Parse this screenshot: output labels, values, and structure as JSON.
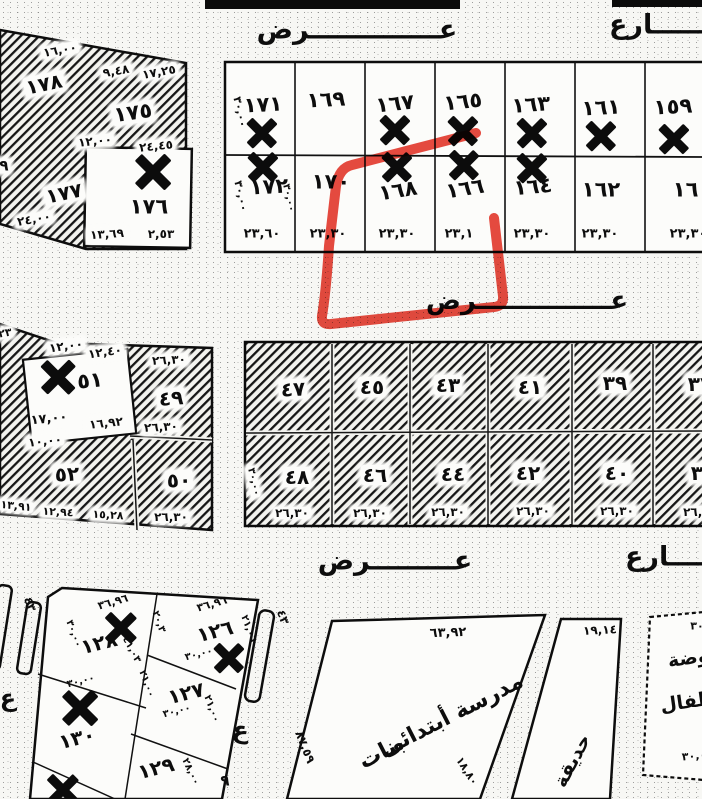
{
  "map": {
    "type": "scanned cadastral plot map",
    "annotation_color": "#e4372b",
    "ink_color": "#0d0d0d",
    "paper_color": "#f7f7f4"
  },
  "labels": {
    "streets": [
      {
        "n": "street-top-ard-label",
        "t": "عــــــــــــــرض",
        "x": 357,
        "y": 30,
        "s": 27,
        "r": 0
      },
      {
        "n": "street-top-sharia-label",
        "t": "شــــــارع",
        "x": 672,
        "y": 25,
        "s": 27,
        "r": 0
      },
      {
        "n": "street-middle-ard-label",
        "t": "عـــــــــــــــرض",
        "x": 527,
        "y": 301,
        "s": 26,
        "r": 0
      },
      {
        "n": "street-bottom-ard-label",
        "t": "عـــــــــرض",
        "x": 395,
        "y": 561,
        "s": 27,
        "r": 0
      },
      {
        "n": "street-bottom-sharia-label",
        "t": "شــــــارع",
        "x": 688,
        "y": 557,
        "s": 27,
        "r": 0
      }
    ],
    "top_block_numbers": [
      {
        "n": "parcel-171",
        "t": "١٧١",
        "x": 263,
        "y": 105,
        "s": 21,
        "r": -3
      },
      {
        "n": "parcel-169",
        "t": "١٦٩",
        "x": 326,
        "y": 100,
        "s": 21,
        "r": -3
      },
      {
        "n": "parcel-167",
        "t": "١٦٧",
        "x": 395,
        "y": 104,
        "s": 21,
        "r": -6
      },
      {
        "n": "parcel-165",
        "t": "١٦٥",
        "x": 463,
        "y": 102,
        "s": 21,
        "r": -6
      },
      {
        "n": "parcel-163",
        "t": "١٦٣",
        "x": 531,
        "y": 105,
        "s": 21,
        "r": -4
      },
      {
        "n": "parcel-161",
        "t": "١٦١",
        "x": 601,
        "y": 108,
        "s": 21,
        "r": -3
      },
      {
        "n": "parcel-159",
        "t": "١٥٩",
        "x": 673,
        "y": 107,
        "s": 21,
        "r": -3
      },
      {
        "n": "parcel-172",
        "t": "١٧٢",
        "x": 269,
        "y": 187,
        "s": 21,
        "r": -3
      },
      {
        "n": "parcel-170",
        "t": "١٧٠",
        "x": 331,
        "y": 182,
        "s": 21,
        "r": 0
      },
      {
        "n": "parcel-168",
        "t": "١٦٨",
        "x": 398,
        "y": 191,
        "s": 21,
        "r": -9
      },
      {
        "n": "parcel-166",
        "t": "١٦٦",
        "x": 465,
        "y": 189,
        "s": 21,
        "r": -9
      },
      {
        "n": "parcel-164",
        "t": "١٦٤",
        "x": 533,
        "y": 187,
        "s": 21,
        "r": -5
      },
      {
        "n": "parcel-162",
        "t": "١٦٢",
        "x": 601,
        "y": 190,
        "s": 21,
        "r": 0
      },
      {
        "n": "parcel-160",
        "t": "١٦٠",
        "x": 692,
        "y": 190,
        "s": 21,
        "r": 0
      }
    ],
    "top_block_dims": [
      {
        "n": "dim",
        "t": "٢٣,٦٠",
        "x": 262,
        "y": 234,
        "s": 13,
        "r": 0
      },
      {
        "n": "dim",
        "t": "٢٣,٣٠",
        "x": 328,
        "y": 234,
        "s": 13,
        "r": 0
      },
      {
        "n": "dim",
        "t": "٢٣,٣٠",
        "x": 397,
        "y": 234,
        "s": 13,
        "r": 0
      },
      {
        "n": "dim",
        "t": "٢٣,١",
        "x": 459,
        "y": 234,
        "s": 13,
        "r": 0
      },
      {
        "n": "dim",
        "t": "٢٣,٣٠",
        "x": 532,
        "y": 234,
        "s": 13,
        "r": 0
      },
      {
        "n": "dim",
        "t": "٢٣,٣٠",
        "x": 600,
        "y": 234,
        "s": 13,
        "r": 0
      },
      {
        "n": "dim",
        "t": "٢٣,٣٠",
        "x": 688,
        "y": 234,
        "s": 13,
        "r": 0
      },
      {
        "n": "dim-rot",
        "t": "٣٠,٠٠",
        "x": 240,
        "y": 112,
        "s": 11,
        "r": 78
      },
      {
        "n": "dim-rot",
        "t": "٣٠,٠٠",
        "x": 241,
        "y": 196,
        "s": 11,
        "r": 78
      },
      {
        "n": "dim-rot",
        "t": "٣٠,٠٠",
        "x": 288,
        "y": 198,
        "s": 10,
        "r": 78
      }
    ],
    "nw_block": [
      {
        "n": "parcel-178",
        "t": "١٧٨",
        "x": 44,
        "y": 84,
        "s": 20,
        "r": -12,
        "b": 1
      },
      {
        "n": "parcel-175",
        "t": "١٧٥",
        "x": 133,
        "y": 113,
        "s": 21,
        "r": -8,
        "b": 1
      },
      {
        "n": "parcel-177",
        "t": "١٧٧",
        "x": 64,
        "y": 193,
        "s": 20,
        "r": -12,
        "b": 1
      },
      {
        "n": "parcel-176",
        "t": "١٧٦",
        "x": 149,
        "y": 207,
        "s": 21,
        "r": 0
      },
      {
        "n": "dim",
        "t": "١٦,٠٠",
        "x": 60,
        "y": 50,
        "s": 12,
        "r": -10,
        "b": 1
      },
      {
        "n": "dim",
        "t": "٩,٤٨",
        "x": 116,
        "y": 71,
        "s": 12,
        "r": -10,
        "b": 1
      },
      {
        "n": "dim",
        "t": "١٧,٢٥",
        "x": 159,
        "y": 72,
        "s": 12,
        "r": -10,
        "b": 1
      },
      {
        "n": "dim",
        "t": "١٢,٠٠",
        "x": 95,
        "y": 141,
        "s": 12,
        "r": -6,
        "b": 1
      },
      {
        "n": "dim",
        "t": "٢٤,٤٥",
        "x": 156,
        "y": 146,
        "s": 12,
        "r": -6,
        "b": 1
      },
      {
        "n": "dim",
        "t": "٢٤,٠٠",
        "x": 34,
        "y": 219,
        "s": 12,
        "r": -10,
        "b": 1
      },
      {
        "n": "dim",
        "t": "١٣,٦٩",
        "x": 107,
        "y": 234,
        "s": 12,
        "r": -4,
        "b": 1
      },
      {
        "n": "dim",
        "t": "٢,٥٣",
        "x": 161,
        "y": 234,
        "s": 12,
        "r": 0
      },
      {
        "n": "fragment",
        "t": "٩",
        "x": 4,
        "y": 166,
        "s": 15,
        "r": 0,
        "b": 1
      }
    ],
    "left_block": [
      {
        "n": "parcel-51",
        "t": "٥١",
        "x": 90,
        "y": 381,
        "s": 21,
        "r": -6
      },
      {
        "n": "parcel-49",
        "t": "٤٩",
        "x": 171,
        "y": 398,
        "s": 20,
        "r": -4,
        "b": 1
      },
      {
        "n": "parcel-52",
        "t": "٥٢",
        "x": 67,
        "y": 474,
        "s": 20,
        "r": -3,
        "b": 1
      },
      {
        "n": "parcel-50",
        "t": "٥٠",
        "x": 179,
        "y": 480,
        "s": 20,
        "r": -3,
        "b": 1
      },
      {
        "n": "fragment",
        "t": "٢٣",
        "x": 5,
        "y": 333,
        "s": 11,
        "r": -10,
        "b": 1
      },
      {
        "n": "dim",
        "t": "١٢,٠٠",
        "x": 66,
        "y": 346,
        "s": 12,
        "r": -8,
        "b": 1
      },
      {
        "n": "dim",
        "t": "١٢,٤٠",
        "x": 105,
        "y": 352,
        "s": 12,
        "r": -8,
        "b": 1
      },
      {
        "n": "dim",
        "t": "٢٦,٣٠",
        "x": 169,
        "y": 360,
        "s": 12,
        "r": -3,
        "b": 1
      },
      {
        "n": "dim",
        "t": "١٧,٠٠",
        "x": 49,
        "y": 419,
        "s": 13,
        "r": -6
      },
      {
        "n": "dim",
        "t": "١٦,٩٢",
        "x": 106,
        "y": 423,
        "s": 12,
        "r": -6,
        "b": 1
      },
      {
        "n": "dim",
        "t": "٢٦,٣٠",
        "x": 161,
        "y": 427,
        "s": 12,
        "r": -3,
        "b": 1
      },
      {
        "n": "dim",
        "t": "١٠,٠٠",
        "x": 45,
        "y": 441,
        "s": 12,
        "r": -6,
        "b": 1
      },
      {
        "n": "dim",
        "t": "١٣,٩١",
        "x": 16,
        "y": 506,
        "s": 11,
        "r": 6,
        "b": 1
      },
      {
        "n": "dim",
        "t": "١٢,٩٤",
        "x": 58,
        "y": 512,
        "s": 11,
        "r": 3,
        "b": 1
      },
      {
        "n": "dim",
        "t": "١٥,٢٨",
        "x": 108,
        "y": 515,
        "s": 11,
        "r": 3,
        "b": 1
      },
      {
        "n": "dim",
        "t": "٢٦,٣٠",
        "x": 171,
        "y": 517,
        "s": 12,
        "r": 0,
        "b": 1
      }
    ],
    "main_block": [
      {
        "n": "parcel-47",
        "t": "٤٧",
        "x": 293,
        "y": 389,
        "s": 20,
        "r": -3,
        "b": 1
      },
      {
        "n": "parcel-45",
        "t": "٤٥",
        "x": 372,
        "y": 387,
        "s": 20,
        "r": 0,
        "b": 1
      },
      {
        "n": "parcel-43",
        "t": "٤٣",
        "x": 448,
        "y": 385,
        "s": 20,
        "r": 0,
        "b": 1
      },
      {
        "n": "parcel-41",
        "t": "٤١",
        "x": 530,
        "y": 387,
        "s": 20,
        "r": 0,
        "b": 1
      },
      {
        "n": "parcel-39",
        "t": "٣٩",
        "x": 615,
        "y": 383,
        "s": 20,
        "r": 0,
        "b": 1
      },
      {
        "n": "parcel-37",
        "t": "٣٧",
        "x": 700,
        "y": 384,
        "s": 20,
        "r": 0,
        "b": 1
      },
      {
        "n": "parcel-48",
        "t": "٤٨",
        "x": 297,
        "y": 477,
        "s": 20,
        "r": 0,
        "b": 1
      },
      {
        "n": "parcel-46",
        "t": "٤٦",
        "x": 375,
        "y": 475,
        "s": 20,
        "r": 0,
        "b": 1
      },
      {
        "n": "parcel-44",
        "t": "٤٤",
        "x": 453,
        "y": 474,
        "s": 20,
        "r": 0,
        "b": 1
      },
      {
        "n": "parcel-42",
        "t": "٤٢",
        "x": 528,
        "y": 473,
        "s": 20,
        "r": 0,
        "b": 1
      },
      {
        "n": "parcel-40",
        "t": "٤٠",
        "x": 617,
        "y": 473,
        "s": 20,
        "r": 0,
        "b": 1
      },
      {
        "n": "parcel-38",
        "t": "٣٨",
        "x": 703,
        "y": 473,
        "s": 20,
        "r": 0,
        "b": 1
      },
      {
        "n": "dim",
        "t": "٢٦,٣٠",
        "x": 292,
        "y": 513,
        "s": 12,
        "r": 0,
        "b": 1
      },
      {
        "n": "dim",
        "t": "٢٦,٣٠",
        "x": 370,
        "y": 513,
        "s": 12,
        "r": 0,
        "b": 1
      },
      {
        "n": "dim",
        "t": "٢٦,٣٠",
        "x": 448,
        "y": 512,
        "s": 12,
        "r": 0,
        "b": 1
      },
      {
        "n": "dim",
        "t": "٢٦,٣٠",
        "x": 533,
        "y": 511,
        "s": 12,
        "r": 0,
        "b": 1
      },
      {
        "n": "dim",
        "t": "٢٦,٣٠",
        "x": 617,
        "y": 511,
        "s": 12,
        "r": 0,
        "b": 1
      },
      {
        "n": "dim",
        "t": "٢٦,٣٠",
        "x": 700,
        "y": 512,
        "s": 12,
        "r": 0,
        "b": 1
      },
      {
        "n": "dim-rot",
        "t": "٣٠,٠٠",
        "x": 253,
        "y": 482,
        "s": 10,
        "r": 78,
        "b": 1
      }
    ],
    "south_block": [
      {
        "n": "parcel-128",
        "t": "١٢٨",
        "x": 99,
        "y": 643,
        "s": 20,
        "r": -14
      },
      {
        "n": "parcel-126",
        "t": "١٢٦",
        "x": 215,
        "y": 631,
        "s": 20,
        "r": -14
      },
      {
        "n": "parcel-127",
        "t": "١٢٧",
        "x": 186,
        "y": 693,
        "s": 20,
        "r": -14
      },
      {
        "n": "parcel-129",
        "t": "١٢٩",
        "x": 156,
        "y": 768,
        "s": 20,
        "r": -14
      },
      {
        "n": "parcel-130",
        "t": "١٣٠",
        "x": 77,
        "y": 738,
        "s": 20,
        "r": -14
      },
      {
        "n": "dim",
        "t": "٣٦,٩٦",
        "x": 113,
        "y": 602,
        "s": 11,
        "r": -16
      },
      {
        "n": "dim",
        "t": "٣٦,٩٦",
        "x": 212,
        "y": 604,
        "s": 11,
        "r": -16
      },
      {
        "n": "dim-rot",
        "t": "٣٠,٠٠",
        "x": 73,
        "y": 634,
        "s": 10,
        "r": 70
      },
      {
        "n": "dim-rot",
        "t": "٢٠,٣",
        "x": 158,
        "y": 622,
        "s": 10,
        "r": 70
      },
      {
        "n": "dim-rot",
        "t": "٤١,٠٣",
        "x": 131,
        "y": 650,
        "s": 10,
        "r": 62
      },
      {
        "n": "dim-rot",
        "t": "٢١,٠٦",
        "x": 248,
        "y": 629,
        "s": 10,
        "r": 70
      },
      {
        "n": "dim",
        "t": "٣٠,٠٠",
        "x": 199,
        "y": 655,
        "s": 10,
        "r": -14
      },
      {
        "n": "dim-rot",
        "t": "٢١,٠٠",
        "x": 146,
        "y": 684,
        "s": 10,
        "r": 70
      },
      {
        "n": "dim",
        "t": "٣٠,٠٠",
        "x": 81,
        "y": 682,
        "s": 10,
        "r": -14
      },
      {
        "n": "dim",
        "t": "٣٠,٠٠",
        "x": 177,
        "y": 712,
        "s": 10,
        "r": -14
      },
      {
        "n": "dim-rot",
        "t": "٢١,٠٠",
        "x": 211,
        "y": 709,
        "s": 10,
        "r": 70
      },
      {
        "n": "dim-rot",
        "t": "٢٨,٠٠",
        "x": 190,
        "y": 772,
        "s": 10,
        "r": 65
      }
    ],
    "street_fragments": [
      {
        "n": "fragment-43",
        "t": "٤٣",
        "x": 30,
        "y": 604,
        "s": 12,
        "r": 70
      },
      {
        "n": "fragment-ain",
        "t": "ع",
        "x": 8,
        "y": 698,
        "s": 24,
        "r": 0
      },
      {
        "n": "fragment-43",
        "t": "٤٣",
        "x": 283,
        "y": 617,
        "s": 12,
        "r": 70
      },
      {
        "n": "fragment-ain",
        "t": "ع",
        "x": 241,
        "y": 730,
        "s": 24,
        "r": 10
      },
      {
        "n": "fragment-9",
        "t": "٩",
        "x": 225,
        "y": 781,
        "s": 15,
        "r": 0
      }
    ],
    "school": [
      {
        "n": "school-dim-top",
        "t": "٦٣,٩٢",
        "x": 448,
        "y": 633,
        "s": 13,
        "r": -2
      },
      {
        "n": "school-name-line1",
        "t": "مدرسة أبتدائى",
        "x": 452,
        "y": 716,
        "s": 22,
        "r": -27
      },
      {
        "n": "school-name-line2",
        "t": "بنات",
        "x": 382,
        "y": 753,
        "s": 22,
        "r": -27
      },
      {
        "n": "school-dim-left",
        "t": "٨٧,٥٩",
        "x": 305,
        "y": 747,
        "s": 12,
        "r": 68
      },
      {
        "n": "school-dim-right",
        "t": "١٨,٨٠",
        "x": 467,
        "y": 771,
        "s": 11,
        "r": 58
      }
    ],
    "garden": [
      {
        "n": "garden-dim",
        "t": "١٩,١٤",
        "x": 600,
        "y": 630,
        "s": 12,
        "r": -3
      },
      {
        "n": "garden-label",
        "t": "حديقة",
        "x": 573,
        "y": 761,
        "s": 19,
        "r": -62
      }
    ],
    "kindergarten": [
      {
        "n": "kindergarten-label-line1",
        "t": "روضة",
        "x": 694,
        "y": 658,
        "s": 19,
        "r": -8
      },
      {
        "n": "kindergarten-label-line2",
        "t": "أطفال",
        "x": 691,
        "y": 702,
        "s": 19,
        "r": -8
      },
      {
        "n": "fragment",
        "t": "٣٠",
        "x": 697,
        "y": 626,
        "s": 11,
        "r": 0
      },
      {
        "n": "fragment",
        "t": "٣٠,٠",
        "x": 694,
        "y": 756,
        "s": 11,
        "r": -5
      }
    ]
  },
  "xmarks": [
    {
      "x": 262,
      "y": 133,
      "s": 34
    },
    {
      "x": 395,
      "y": 130,
      "s": 34
    },
    {
      "x": 463,
      "y": 131,
      "s": 34
    },
    {
      "x": 532,
      "y": 133,
      "s": 34
    },
    {
      "x": 601,
      "y": 136,
      "s": 34
    },
    {
      "x": 674,
      "y": 139,
      "s": 34
    },
    {
      "x": 263,
      "y": 167,
      "s": 34
    },
    {
      "x": 397,
      "y": 167,
      "s": 34
    },
    {
      "x": 464,
      "y": 165,
      "s": 34
    },
    {
      "x": 532,
      "y": 168,
      "s": 34
    },
    {
      "x": 153,
      "y": 172,
      "s": 40
    },
    {
      "x": 58,
      "y": 377,
      "s": 38
    },
    {
      "x": 121,
      "y": 628,
      "s": 36
    },
    {
      "x": 229,
      "y": 658,
      "s": 34
    },
    {
      "x": 80,
      "y": 708,
      "s": 40
    },
    {
      "x": 63,
      "y": 790,
      "s": 36
    }
  ]
}
